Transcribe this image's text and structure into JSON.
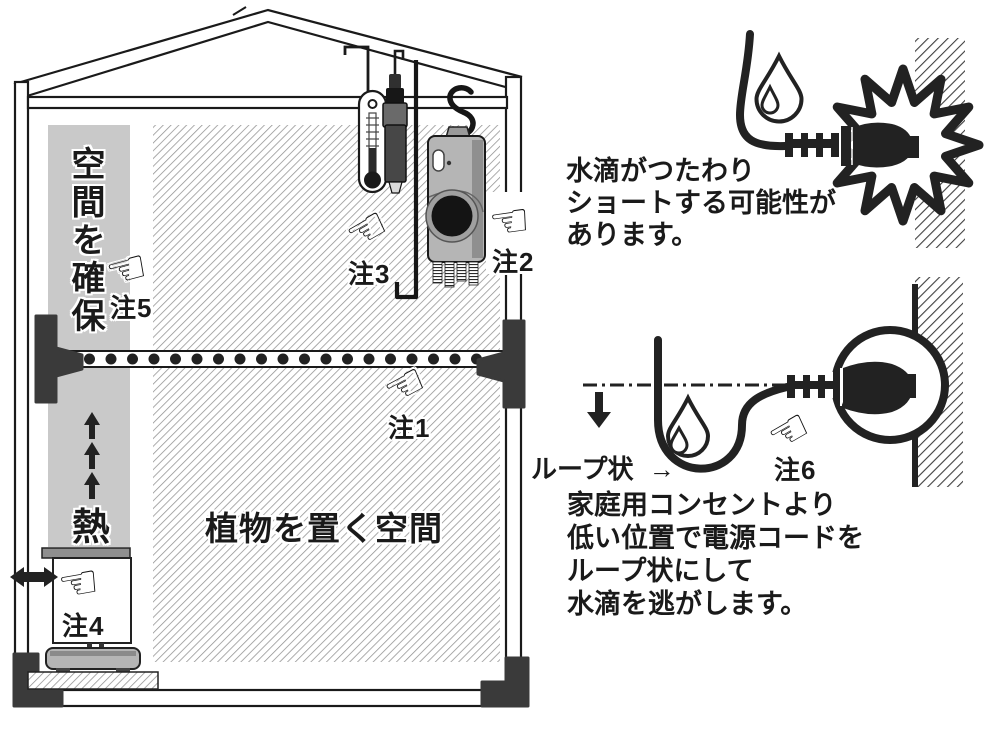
{
  "greenhouse": {
    "space_label": "空間を確保",
    "heat_label": "熱",
    "plant_area_label": "植物を置く空間",
    "note1": "注1",
    "note2": "注2",
    "note3": "注3",
    "note4": "注4",
    "note5": "注5"
  },
  "short_circuit_diagram": {
    "caption": [
      "水滴がつたわり",
      "ショートする可能性が",
      "あります。"
    ]
  },
  "drip_loop_diagram": {
    "loop_label": "ループ状",
    "loop_arrow": "→",
    "note6": "注6",
    "caption": [
      "家庭用コンセントより",
      "低い位置で電源コードを",
      "ループ状にして",
      "水滴を逃がします。"
    ]
  },
  "icons": {
    "pointing_hand": "☜"
  },
  "colors": {
    "ink": "#1a1a1a",
    "light_panel": "#c9c9c9",
    "device_body": "#b5b5b5",
    "bracket": "#3a3a3a"
  }
}
